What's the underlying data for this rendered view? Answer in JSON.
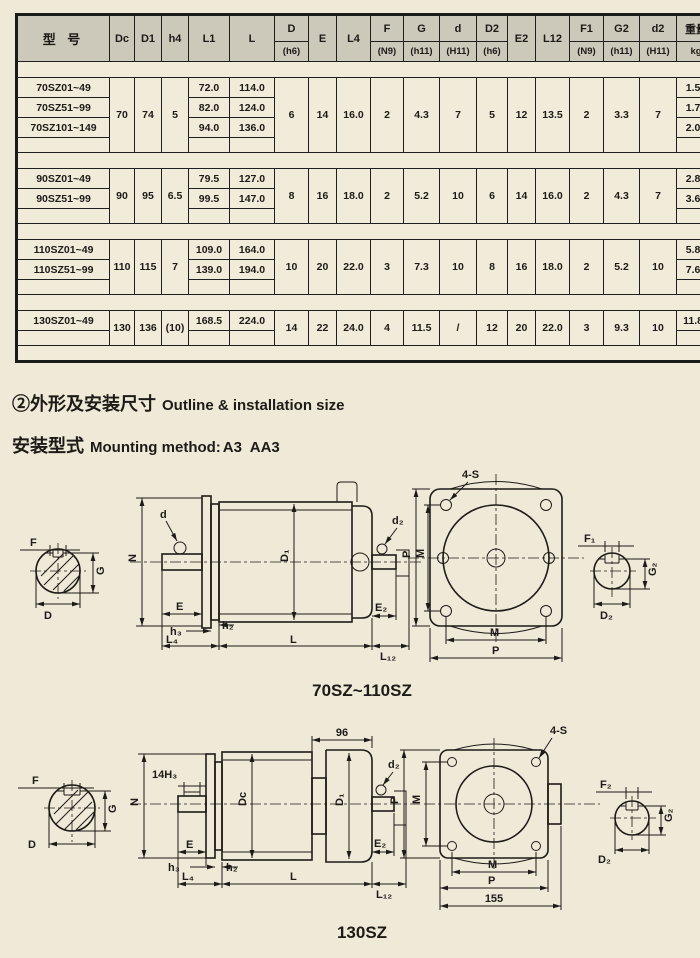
{
  "page": {
    "bg_color": "#efe9d8",
    "ink_color": "#1d1b17",
    "header_bg": "#ccc8ba"
  },
  "table": {
    "header": {
      "model": "型 号",
      "cols": [
        {
          "top": "Dc",
          "bottom": ""
        },
        {
          "top": "D1",
          "bottom": ""
        },
        {
          "top": "h4",
          "bottom": ""
        },
        {
          "top": "L1",
          "bottom": ""
        },
        {
          "top": "L",
          "bottom": ""
        },
        {
          "top": "D",
          "bottom": "(h6)"
        },
        {
          "top": "E",
          "bottom": ""
        },
        {
          "top": "L4",
          "bottom": ""
        },
        {
          "top": "F",
          "bottom": "(N9)"
        },
        {
          "top": "G",
          "bottom": "(h11)"
        },
        {
          "top": "d",
          "bottom": "(H11)"
        },
        {
          "top": "D2",
          "bottom": "(h6)"
        },
        {
          "top": "E2",
          "bottom": ""
        },
        {
          "top": "L12",
          "bottom": ""
        },
        {
          "top": "F1",
          "bottom": "(N9)"
        },
        {
          "top": "G2",
          "bottom": "(h11)"
        },
        {
          "top": "d2",
          "bottom": "(H11)"
        },
        {
          "top": "重量",
          "bottom": "kg"
        }
      ]
    },
    "blocks": [
      {
        "shared": {
          "Dc": "70",
          "D1": "74",
          "h4": "5",
          "D": "6",
          "E": "14",
          "L4": "16.0",
          "F": "2",
          "G": "4.3",
          "d": "7",
          "D2": "5",
          "E2": "12",
          "L12": "13.5",
          "F1": "2",
          "G2": "3.3",
          "d2": "7"
        },
        "rows": [
          {
            "model": "70SZ01~49",
            "L1": "72.0",
            "L": "114.0",
            "kg": "1.50"
          },
          {
            "model": "70SZ51~99",
            "L1": "82.0",
            "L": "124.0",
            "kg": "1.70"
          },
          {
            "model": "70SZ101~149",
            "L1": "94.0",
            "L": "136.0",
            "kg": "2.00"
          }
        ]
      },
      {
        "shared": {
          "Dc": "90",
          "D1": "95",
          "h4": "6.5",
          "D": "8",
          "E": "16",
          "L4": "18.0",
          "F": "2",
          "G": "5.2",
          "d": "10",
          "D2": "6",
          "E2": "14",
          "L12": "16.0",
          "F1": "2",
          "G2": "4.3",
          "d2": "7"
        },
        "rows": [
          {
            "model": "90SZ01~49",
            "L1": "79.5",
            "L": "127.0",
            "kg": "2.80"
          },
          {
            "model": "90SZ51~99",
            "L1": "99.5",
            "L": "147.0",
            "kg": "3.60"
          }
        ]
      },
      {
        "shared": {
          "Dc": "110",
          "D1": "115",
          "h4": "7",
          "D": "10",
          "E": "20",
          "L4": "22.0",
          "F": "3",
          "G": "7.3",
          "d": "10",
          "D2": "8",
          "E2": "16",
          "L12": "18.0",
          "F1": "2",
          "G2": "5.2",
          "d2": "10"
        },
        "rows": [
          {
            "model": "110SZ01~49",
            "L1": "109.0",
            "L": "164.0",
            "kg": "5.80"
          },
          {
            "model": "110SZ51~99",
            "L1": "139.0",
            "L": "194.0",
            "kg": "7.60"
          }
        ]
      },
      {
        "shared": {
          "Dc": "130",
          "D1": "136",
          "h4": "(10)",
          "D": "14",
          "E": "22",
          "L4": "24.0",
          "F": "4",
          "G": "11.5",
          "d": "/",
          "D2": "12",
          "E2": "20",
          "L12": "22.0",
          "F1": "3",
          "G2": "9.3",
          "d2": "10"
        },
        "rows": [
          {
            "model": "130SZ01~49",
            "L1": "168.5",
            "L": "224.0",
            "kg": "11.80"
          }
        ]
      }
    ]
  },
  "headings": {
    "outline": {
      "zh": "②外形及安装尺寸",
      "en": "Outline & installation size"
    },
    "mounting": {
      "zh": "安装型式",
      "en": "Mounting method:",
      "values": "A3  AA3"
    }
  },
  "drawing1": {
    "caption": "70SZ~110SZ",
    "labels": {
      "F": "F",
      "G": "G",
      "D": "D",
      "N": "N",
      "d": "d",
      "D1": "D₁",
      "E": "E",
      "h3": "h₃",
      "h2": "h₂",
      "L4": "L₄",
      "L": "L",
      "d2": "d₂",
      "E2": "E₂",
      "L12": "L₁₂",
      "s": "4-S",
      "P": "P",
      "M": "M",
      "F1": "F₁",
      "G2": "G₂",
      "D2": "D₂"
    }
  },
  "drawing2": {
    "caption": "130SZ",
    "labels": {
      "F": "F",
      "G": "G",
      "D": "D",
      "N": "N",
      "k14": "14H₃",
      "dim96": "96",
      "Dc": "Dc",
      "D1": "D₁",
      "E": "E",
      "h3": "h₃",
      "h2": "h₂",
      "L4": "L₄",
      "L": "L",
      "d2": "d₂",
      "E2": "E₂",
      "L12": "L₁₂",
      "s": "4-S",
      "P": "P",
      "M": "M",
      "dim155": "155",
      "F2": "F₂",
      "G2": "G₂",
      "D2": "D₂"
    }
  }
}
